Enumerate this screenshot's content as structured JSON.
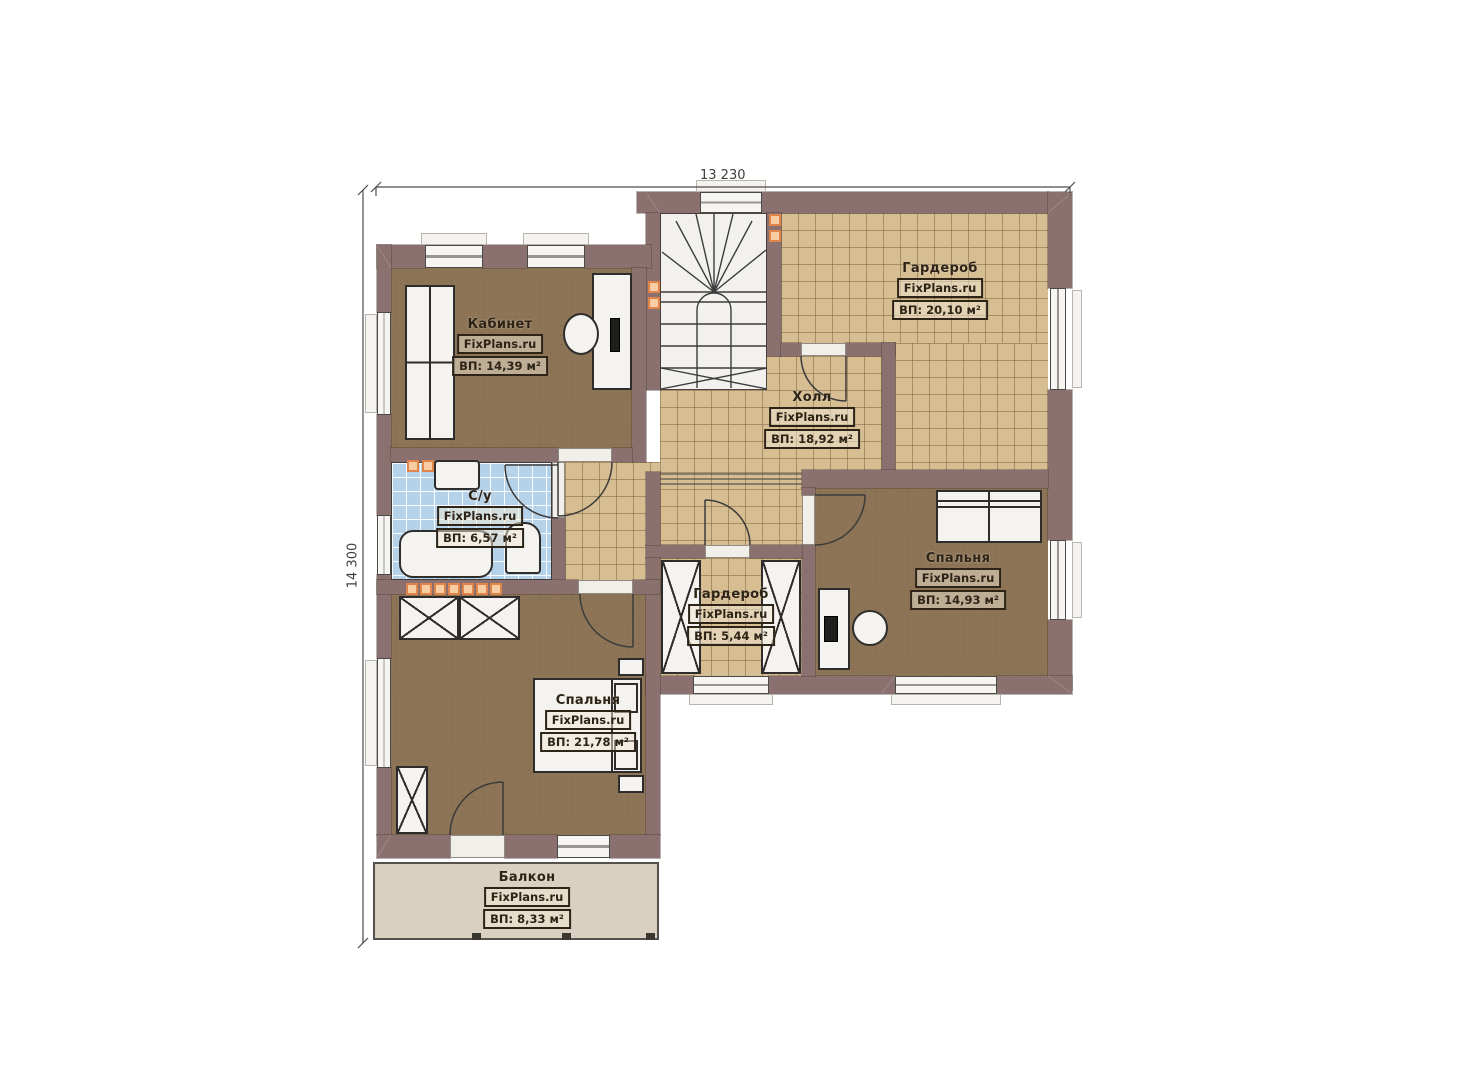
{
  "brand": "FixPlans.ru",
  "dimensions": {
    "width_label": "13 230",
    "height_label": "14 300"
  },
  "rooms": [
    {
      "name": "Кабинет",
      "area": "ВП: 14,39 м²"
    },
    {
      "name": "Гардероб",
      "area": "ВП: 20,10 м²"
    },
    {
      "name": "Холл",
      "area": "ВП: 18,92 м²"
    },
    {
      "name": "С/у",
      "area": "ВП: 6,57 м²"
    },
    {
      "name": "Спальня",
      "area": "ВП: 14,93 м²"
    },
    {
      "name": "Гардероб",
      "area": "ВП: 5,44 м²"
    },
    {
      "name": "Спальня",
      "area": "ВП: 21,78 м²"
    },
    {
      "name": "Балкон",
      "area": "ВП: 8,33 м²"
    }
  ]
}
